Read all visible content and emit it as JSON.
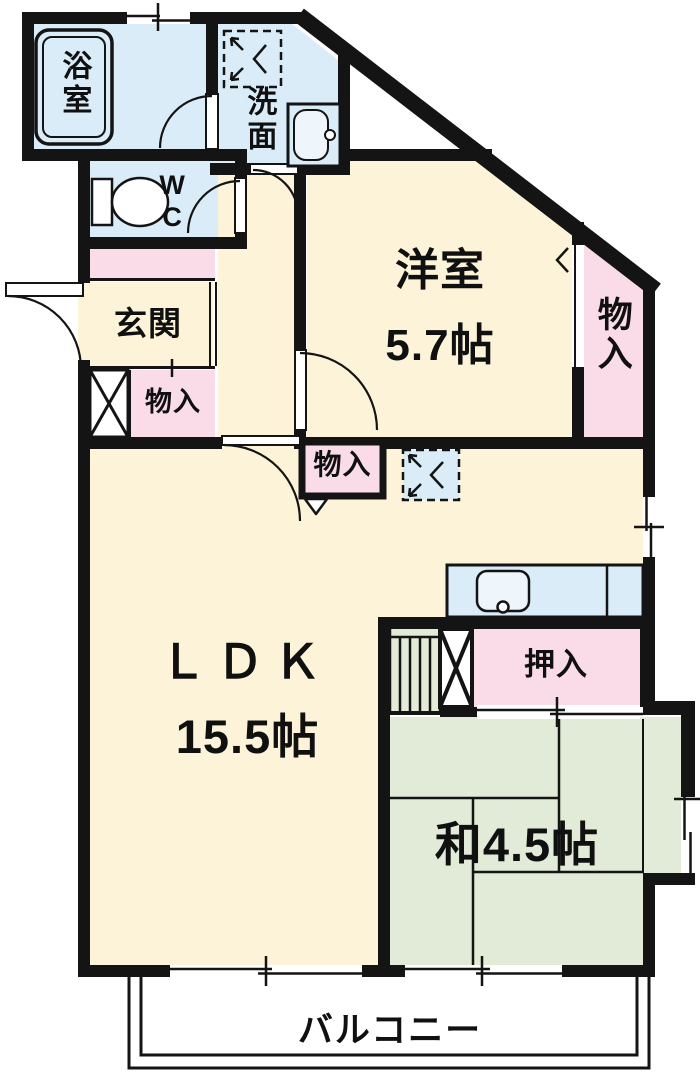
{
  "rooms": {
    "bath": {
      "label": "浴室"
    },
    "washroom": {
      "label": "洗面"
    },
    "wc": {
      "label": "WC"
    },
    "entrance": {
      "label": "玄関"
    },
    "entrance_storage": {
      "label": "物入"
    },
    "western_room": {
      "label": "洋室",
      "size": "5.7帖"
    },
    "east_storage": {
      "label": "物入"
    },
    "ldk_storage": {
      "label": "物入"
    },
    "ldk": {
      "label": "ＬＤＫ",
      "size": "15.5帖"
    },
    "closet": {
      "label": "押入"
    },
    "japanese_room": {
      "label": "和4.5帖"
    },
    "balcony": {
      "label": "バルコニー"
    }
  },
  "icons": {
    "bathtub": "bathtub-icon",
    "toilet": "toilet-icon",
    "vanity_sink": "vanity-sink-icon",
    "washer_pan_laundry": "washer-pan-icon",
    "washer_pan_kitchen": "washer-pan-icon",
    "kitchen_counter": "kitchen-counter-icon",
    "pipe_shaft_entrance": "pipe-shaft-x-icon",
    "pipe_shaft_kitchen": "pipe-shaft-x-icon"
  },
  "colors": {
    "wet": "#d9ecf8",
    "main": "#fcf3d8",
    "pink": "#f9dce8",
    "green": "#e2ebd8",
    "wall": "#141414",
    "paper": "#ffffff"
  }
}
